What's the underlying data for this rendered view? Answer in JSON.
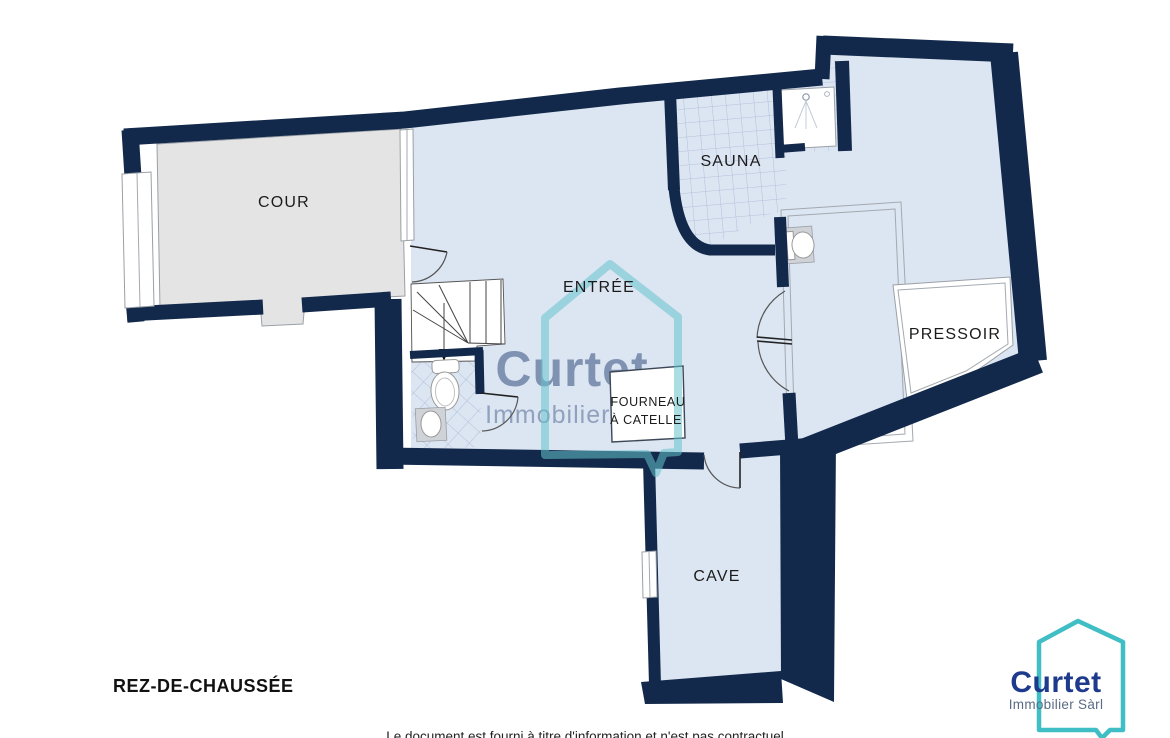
{
  "plan": {
    "floor_label": "REZ-DE-CHAUSSÉE",
    "rooms": {
      "cour": "COUR",
      "sauna": "SAUNA",
      "entree": "ENTRÉE",
      "pressoir": "PRESSOIR",
      "fourneau_line1": "FOURNEAU",
      "fourneau_line2": "À CATELLE",
      "cave": "CAVE"
    },
    "disclaimer": "Le document est fourni à titre d'information et n'est pas contractuel"
  },
  "watermark": {
    "brand": "Curtet",
    "subtitle": "Immobilier Sàrl"
  },
  "logo": {
    "brand": "Curtet",
    "subtitle": "Immobilier Sàrl"
  },
  "colors": {
    "wall": "#13294b",
    "floor": "#dce5f2",
    "tile_line": "#a6b7d4",
    "cour_floor": "#e4e4e5",
    "teal": "#3fbec6",
    "watermark_teal": "#64c3cc",
    "watermark_text": "#34507e",
    "logo_navy": "#1e3a8c",
    "logo_gray": "#5a6b85"
  }
}
